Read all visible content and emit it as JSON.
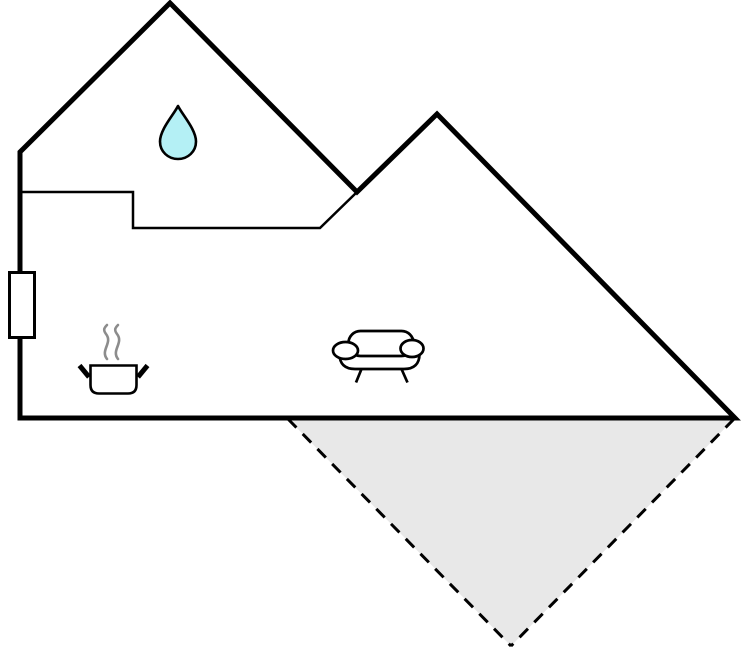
{
  "page": {
    "type": "floor-plan-diagram",
    "width": 743,
    "height": 652
  },
  "colors": {
    "background": "#ffffff",
    "outline": "#000000",
    "icon_fill": "#ffffff",
    "water_drop_fill": "#b4f0f5",
    "terrace_fill": "#e8e8e8",
    "steam_gray": "#8c8c8c"
  },
  "icons": [
    {
      "name": "water-drop-icon"
    },
    {
      "name": "cooking-pot-icon"
    },
    {
      "name": "steam-icon"
    },
    {
      "name": "sofa-icon"
    },
    {
      "name": "window-icon"
    },
    {
      "name": "terrace-area"
    }
  ]
}
